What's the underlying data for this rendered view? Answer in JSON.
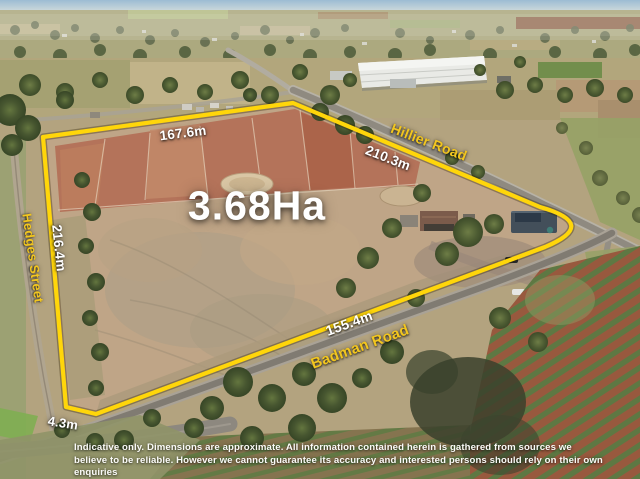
{
  "listing": {
    "area_label": "3.68Ha",
    "dimensions": {
      "top_boundary": "167.6m",
      "north_east_boundary": "210.3m",
      "west_boundary": "216.4m",
      "south_boundary": "155.4m",
      "south_west_boundary": "4.3m"
    },
    "roads": {
      "north": "Hillier Road",
      "west": "Hedges Street",
      "south": "Badman Road"
    },
    "colors": {
      "boundary_line": "#FFD60A",
      "road_label": "#F2C61F",
      "dimension_label": "#FFFFFF"
    },
    "disclaimer": {
      "line1": "Indicative only. Dimensions are approximate. All information contained herein is gathered from sources we",
      "line2": "believe to be reliable. However we cannot guarantee its accuracy and interested persons should rely on their own enquiries"
    }
  }
}
